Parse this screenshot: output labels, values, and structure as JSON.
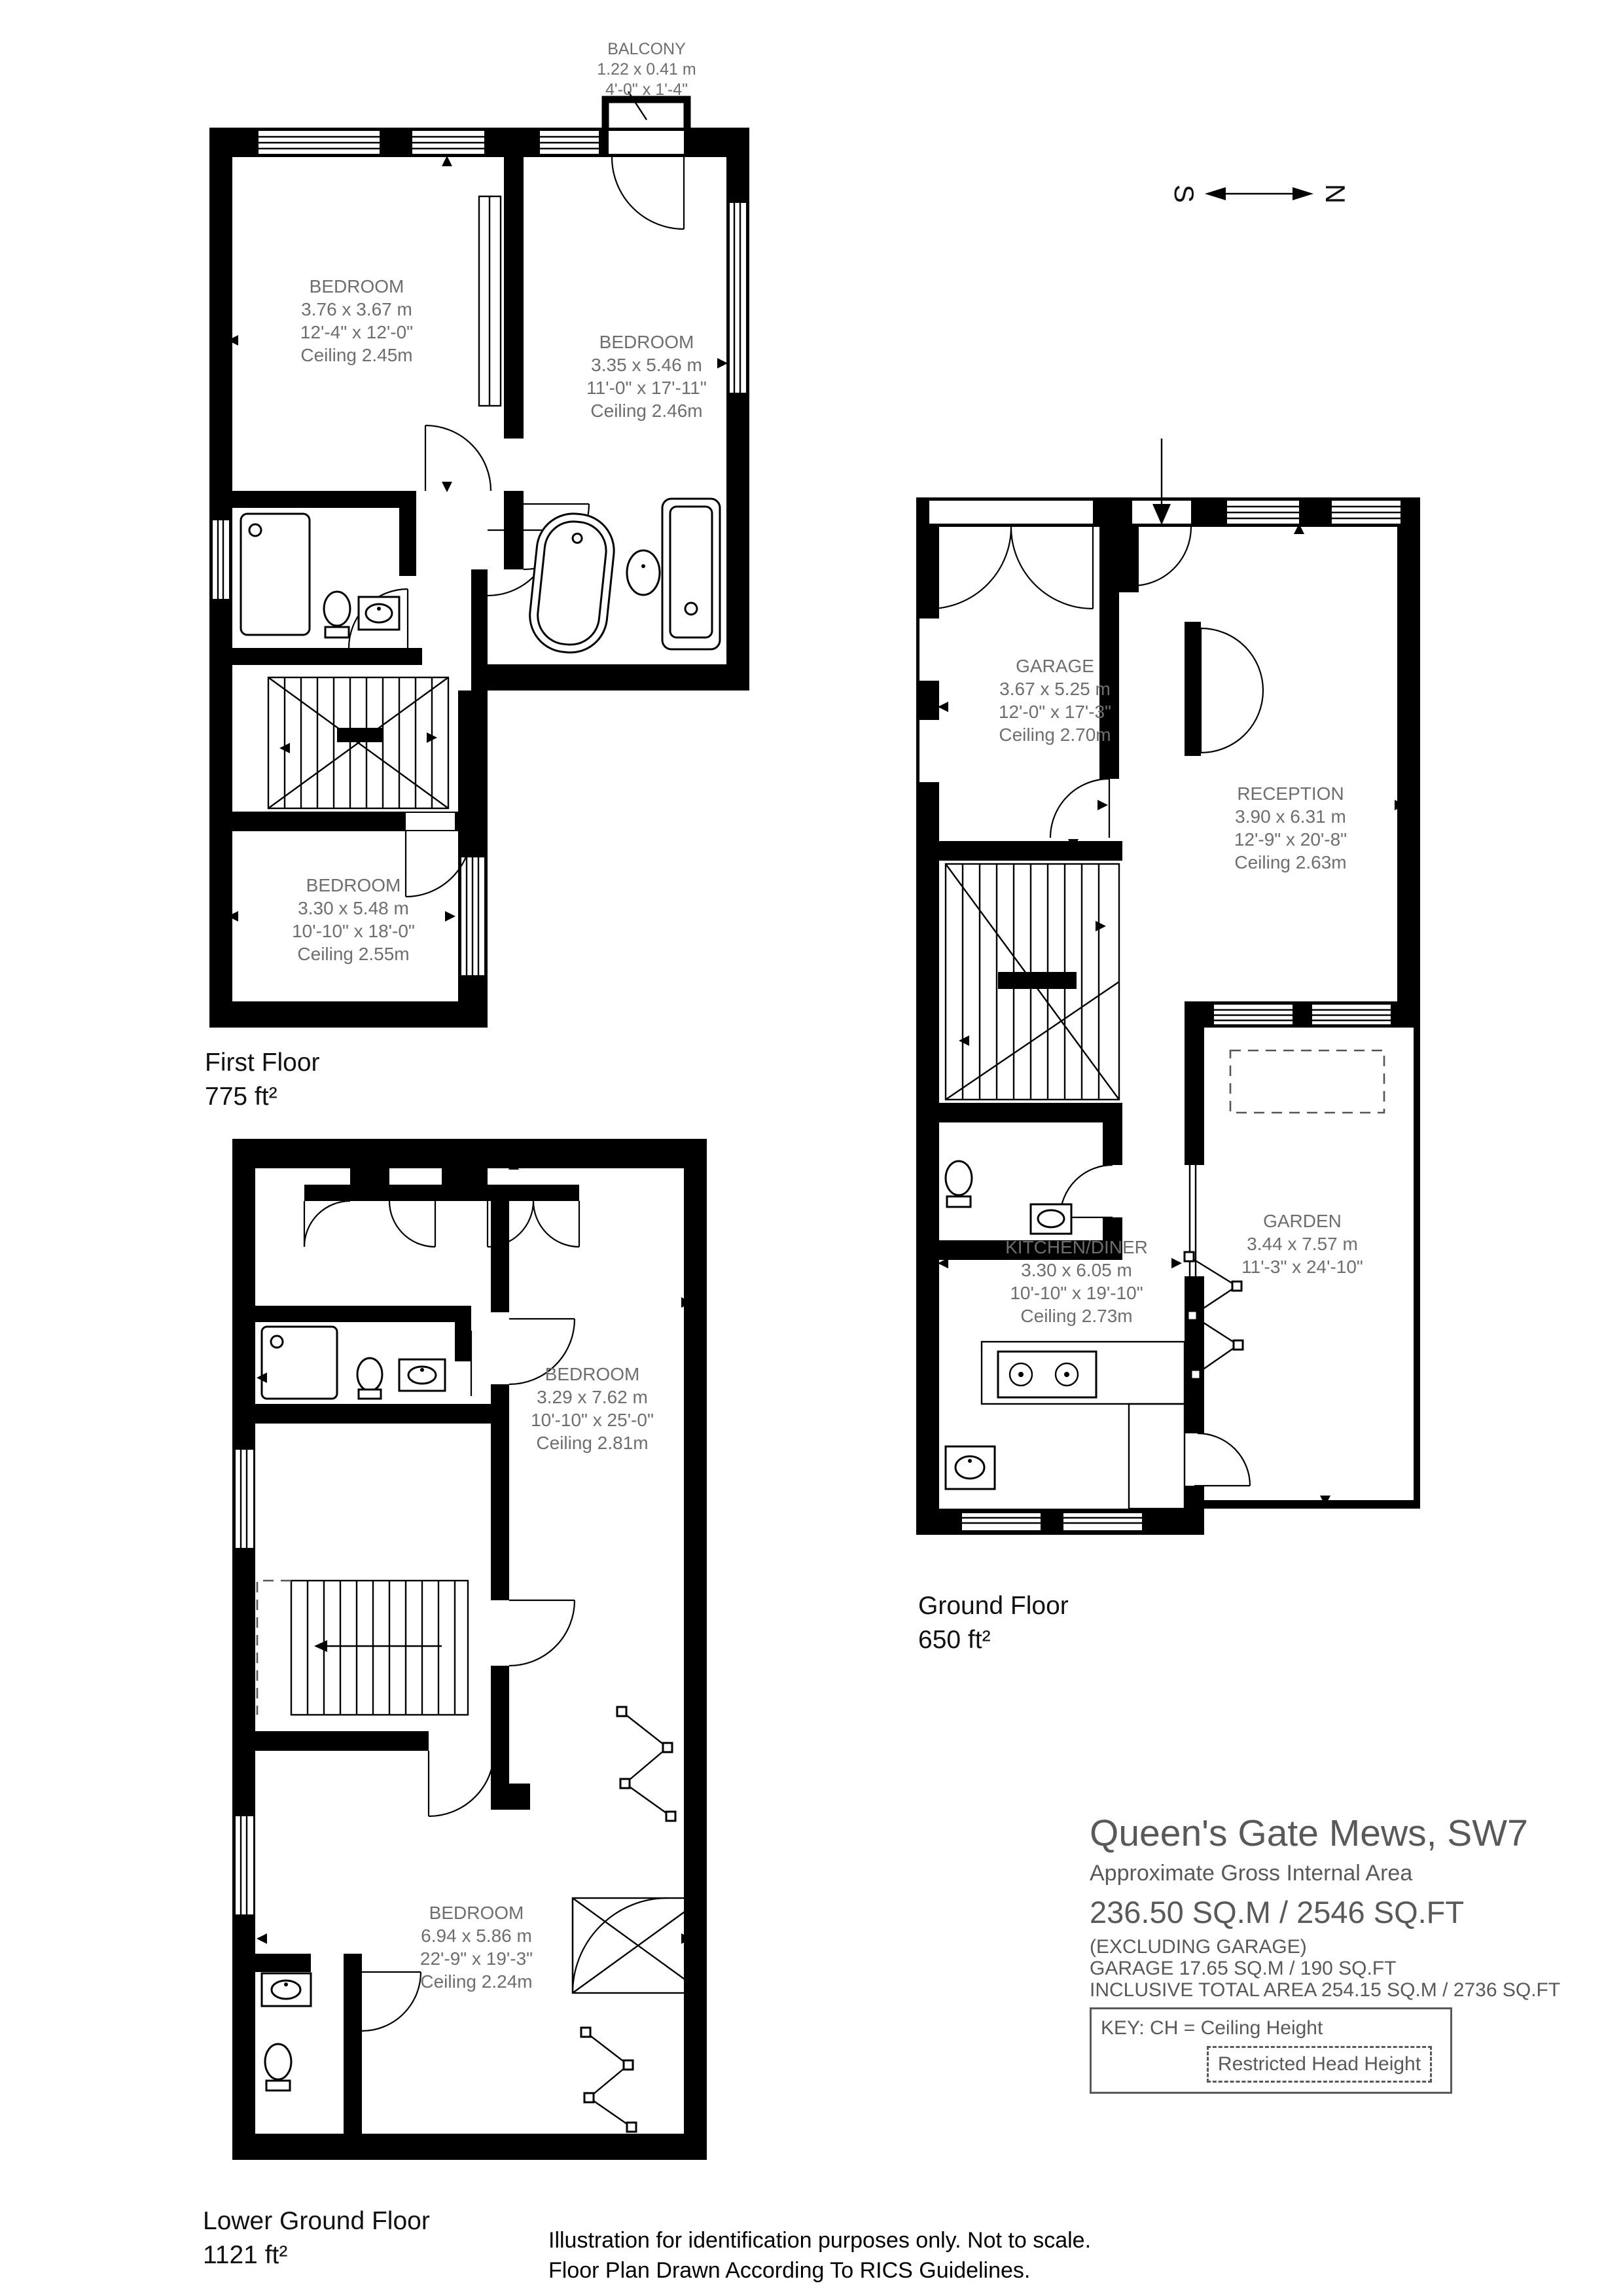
{
  "page": {
    "background": "#ffffff"
  },
  "colors": {
    "walls": "#000000",
    "room_label": "#6e6e6e",
    "title_text": "#58595b",
    "caption_text": "#111111"
  },
  "compass": {
    "south": "S",
    "north": "N"
  },
  "floors": {
    "first": {
      "caption": "First Floor",
      "area": "775 ft²",
      "rooms": {
        "balcony": {
          "name": "BALCONY",
          "metric": "1.22 x 0.41 m",
          "imperial": "4'-0\" x 1'-4\""
        },
        "bedroom_front": {
          "name": "BEDROOM",
          "metric": "3.76 x 3.67 m",
          "imperial": "12'-4\" x 12'-0\"",
          "ceiling": "Ceiling 2.45m"
        },
        "bedroom_middle": {
          "name": "BEDROOM",
          "metric": "3.35 x 5.46 m",
          "imperial": "11'-0\" x 17'-11\"",
          "ceiling": "Ceiling 2.46m"
        },
        "bedroom_rear": {
          "name": "BEDROOM",
          "metric": "3.30 x 5.48 m",
          "imperial": "10'-10\" x 18'-0\"",
          "ceiling": "Ceiling 2.55m"
        }
      }
    },
    "ground": {
      "caption": "Ground Floor",
      "area": "650 ft²",
      "rooms": {
        "garage": {
          "name": "GARAGE",
          "metric": "3.67 x 5.25 m",
          "imperial": "12'-0\" x 17'-3\"",
          "ceiling": "Ceiling 2.70m"
        },
        "reception": {
          "name": "RECEPTION",
          "metric": "3.90 x 6.31 m",
          "imperial": "12'-9\" x 20'-8\"",
          "ceiling": "Ceiling 2.63m"
        },
        "kitchen_diner": {
          "name": "KITCHEN/DINER",
          "metric": "3.30 x 6.05 m",
          "imperial": "10'-10\" x 19'-10\"",
          "ceiling": "Ceiling 2.73m"
        },
        "garden": {
          "name": "GARDEN",
          "metric": "3.44 x 7.57 m",
          "imperial": "11'-3\" x 24'-10\""
        }
      }
    },
    "lower_ground": {
      "caption": "Lower Ground Floor",
      "area": "1121 ft²",
      "rooms": {
        "bedroom_upper": {
          "name": "BEDROOM",
          "metric": "3.29 x 7.62 m",
          "imperial": "10'-10\" x 25'-0\"",
          "ceiling": "Ceiling 2.81m"
        },
        "bedroom_main": {
          "name": "BEDROOM",
          "metric": "6.94 x 5.86 m",
          "imperial": "22'-9\" x 19'-3\"",
          "ceiling": "Ceiling 2.24m"
        }
      }
    }
  },
  "title_block": {
    "title": "Queen's Gate Mews, SW7",
    "subtitle": "Approximate Gross Internal Area",
    "total_area": "236.50 SQ.M / 2546 SQ.FT",
    "excluding": "(EXCLUDING GARAGE)",
    "garage_area": "GARAGE  17.65 SQ.M / 190 SQ.FT",
    "inclusive_total": "INCLUSIVE TOTAL AREA 254.15 SQ.M / 2736 SQ.FT",
    "key_label": "KEY: CH = Ceiling Height",
    "key_restricted": "Restricted Head Height"
  },
  "disclaimer": {
    "line1": "Illustration for identification purposes only. Not to scale.",
    "line2": "Floor Plan Drawn According To RICS Guidelines."
  }
}
